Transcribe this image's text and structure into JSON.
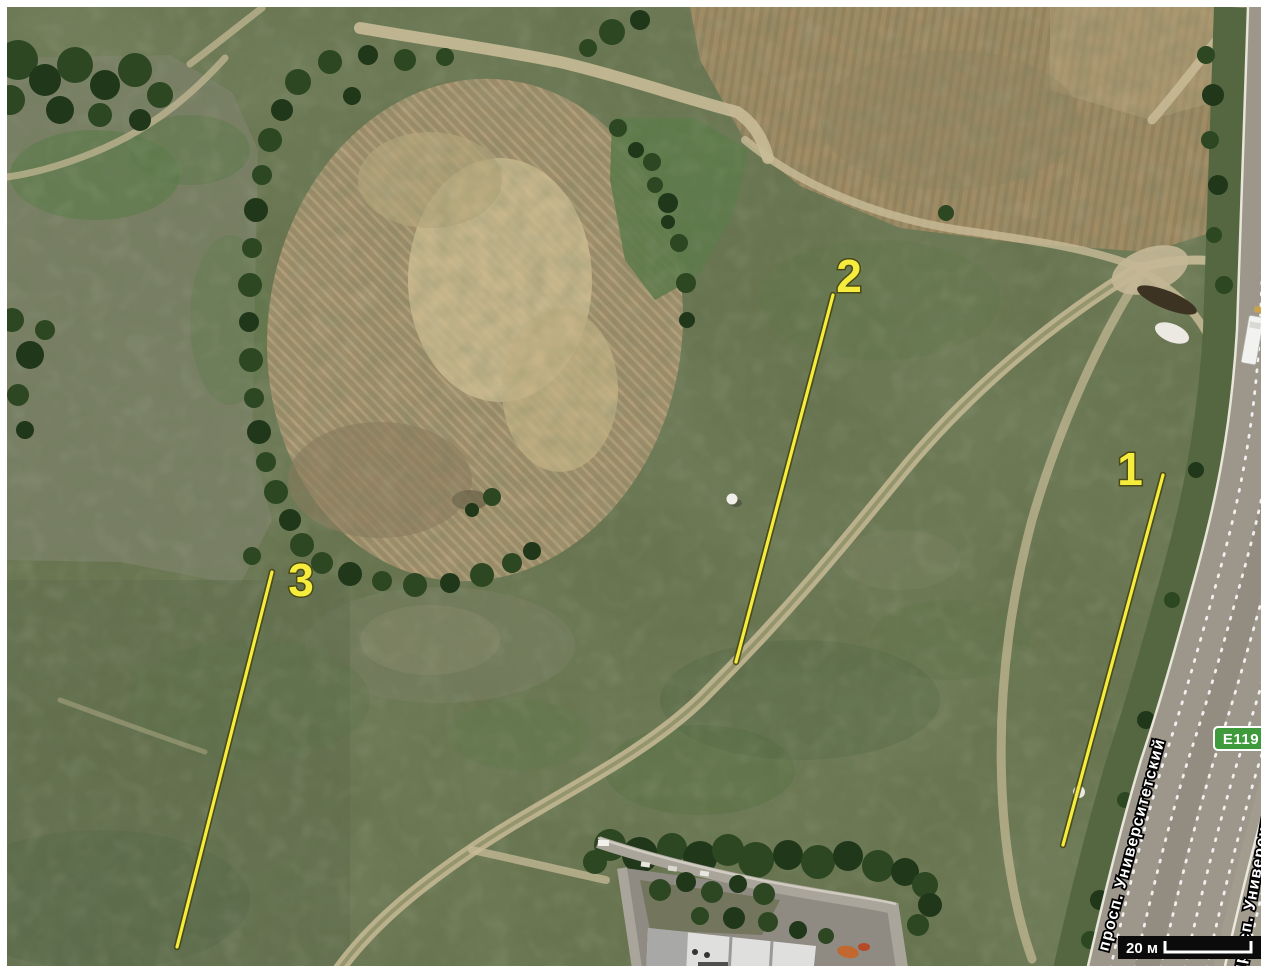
{
  "map": {
    "annotation_color": "#f5ec3e",
    "markers": [
      {
        "label": "1",
        "line": {
          "x1": 1163,
          "y1": 475,
          "x2": 1063,
          "y2": 845
        },
        "label_x": 1130,
        "label_y": 485
      },
      {
        "label": "2",
        "line": {
          "x1": 833,
          "y1": 295,
          "x2": 736,
          "y2": 662
        },
        "label_x": 849,
        "label_y": 292
      },
      {
        "label": "3",
        "line": {
          "x1": 272,
          "y1": 572,
          "x2": 177,
          "y2": 947
        },
        "label_x": 301,
        "label_y": 596
      }
    ],
    "road_labels": [
      {
        "text": "просп. Университетский",
        "x": 1108,
        "y": 952,
        "angle": -75
      },
      {
        "text": "просп. Университетский",
        "x": 1243,
        "y": 975,
        "angle": -80
      }
    ],
    "route_badge": {
      "text": "E119",
      "color": "#3e9a3b"
    },
    "scale_bar": {
      "label": "20 м"
    }
  }
}
